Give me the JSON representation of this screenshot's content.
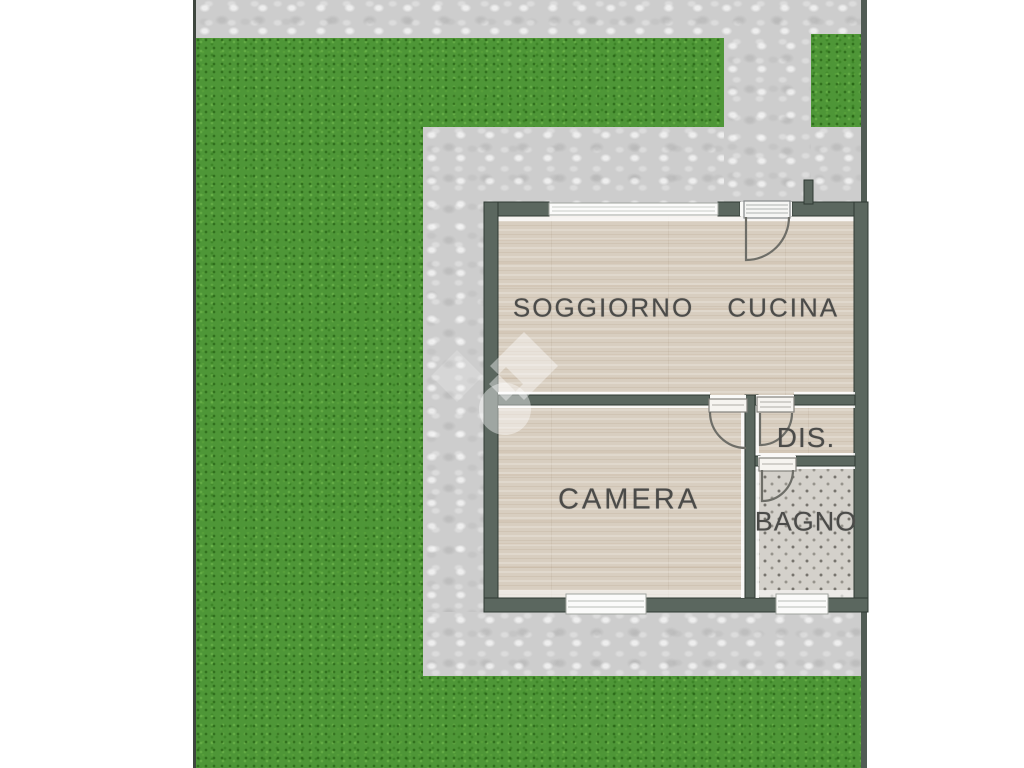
{
  "document": {
    "type": "floor-plan",
    "language": "it",
    "description": "Planimetria appartamento con giardino"
  },
  "rooms": [
    {
      "id": "soggiorno-cucina",
      "label": "SOGGIORNO CUCINA"
    },
    {
      "id": "camera",
      "label": "CAMERA"
    },
    {
      "id": "disimpegno",
      "label": "DIS."
    },
    {
      "id": "bagno",
      "label": "BAGNO"
    }
  ],
  "outdoor": {
    "lawn": "grass",
    "path": "stone-paving"
  },
  "icons": {
    "watermark": "house-diamond-and-circle-watermark",
    "doors": [
      "entrance-door",
      "camera-door",
      "dis-door",
      "bagno-door"
    ],
    "windows": [
      "top-window",
      "camera-window",
      "bagno-window"
    ]
  },
  "colors": {
    "background": "#ffffff",
    "grass": "#4e9637",
    "paving": "#cdcdcd",
    "wall": "#5b675f",
    "wall_outline": "#2f3a33",
    "wood_floor": "#d8cec0",
    "bagno_tile": "#d4d1cb",
    "label_text": "#4b4b49",
    "border_line": "#3e463e"
  }
}
